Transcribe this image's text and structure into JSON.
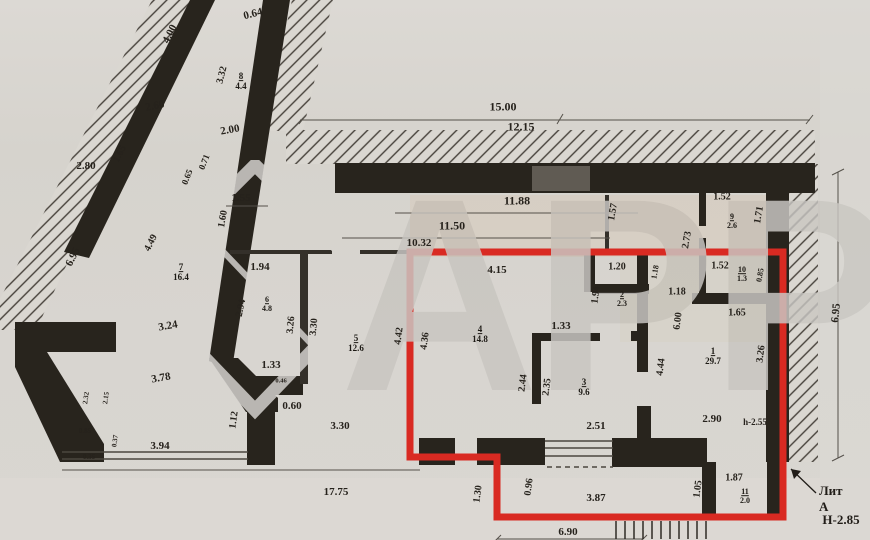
{
  "plan": {
    "watermark": "АРР",
    "litera": "Лит А",
    "height_note": "Н-2.85",
    "colors": {
      "red_outline": "#d92a22",
      "wall": "#28241d",
      "paper": "#d7d4cf"
    },
    "rooms": [
      {
        "n": "8",
        "a": "4.4",
        "x": 241,
        "y": 82,
        "s": 9
      },
      {
        "n": "7",
        "a": "16.4",
        "x": 181,
        "y": 273,
        "s": 9
      },
      {
        "n": "6",
        "a": "4.8",
        "x": 267,
        "y": 305,
        "s": 8
      },
      {
        "n": "5",
        "a": "12.6",
        "x": 356,
        "y": 344,
        "s": 9
      },
      {
        "n": "9",
        "a": "2.6",
        "x": 732,
        "y": 222,
        "s": 8
      },
      {
        "n": "10",
        "a": "1.3",
        "x": 742,
        "y": 275,
        "s": 8
      },
      {
        "n": "2",
        "a": "2.3",
        "x": 622,
        "y": 300,
        "s": 8
      },
      {
        "n": "4",
        "a": "14.8",
        "x": 480,
        "y": 335,
        "s": 9
      },
      {
        "n": "1",
        "a": "29.7",
        "x": 713,
        "y": 357,
        "s": 9
      },
      {
        "n": "3",
        "a": "9.6",
        "x": 584,
        "y": 388,
        "s": 9
      },
      {
        "n": "11",
        "a": "2.0",
        "x": 745,
        "y": 497,
        "s": 8
      }
    ],
    "dimensions": [
      {
        "t": "0.64",
        "x": 253,
        "y": 14,
        "r": -14,
        "s": 11
      },
      {
        "t": "4.00",
        "x": 170,
        "y": 34,
        "r": -63,
        "s": 11
      },
      {
        "t": "3.32",
        "x": 222,
        "y": 75,
        "r": -76,
        "s": 10
      },
      {
        "t": "2.60",
        "x": 155,
        "y": 106,
        "r": -12,
        "s": 11
      },
      {
        "t": "2.00",
        "x": 230,
        "y": 130,
        "r": -10,
        "s": 11
      },
      {
        "t": "1.65",
        "x": 120,
        "y": 154,
        "r": -63,
        "s": 10
      },
      {
        "t": "2.80",
        "x": 86,
        "y": 166,
        "r": 0,
        "s": 11
      },
      {
        "t": "0.71",
        "x": 204,
        "y": 162,
        "r": -68,
        "s": 9
      },
      {
        "t": "0.65",
        "x": 187,
        "y": 177,
        "r": -68,
        "s": 9
      },
      {
        "t": "1.55",
        "x": 241,
        "y": 198,
        "r": 0,
        "s": 11
      },
      {
        "t": "1.60",
        "x": 223,
        "y": 219,
        "r": -80,
        "s": 10
      },
      {
        "t": "6.95",
        "x": 73,
        "y": 257,
        "r": -63,
        "s": 11
      },
      {
        "t": "4.49",
        "x": 151,
        "y": 243,
        "r": -63,
        "s": 10
      },
      {
        "t": "3.24",
        "x": 168,
        "y": 326,
        "r": -10,
        "s": 11
      },
      {
        "t": "3.78",
        "x": 161,
        "y": 378,
        "r": -10,
        "s": 11
      },
      {
        "t": "2.32",
        "x": 86,
        "y": 398,
        "r": -82,
        "s": 7
      },
      {
        "t": "2.15",
        "x": 106,
        "y": 398,
        "r": -82,
        "s": 7
      },
      {
        "t": "0.85",
        "x": 85,
        "y": 431,
        "r": 0,
        "s": 7
      },
      {
        "t": "0.37",
        "x": 115,
        "y": 441,
        "r": -82,
        "s": 7
      },
      {
        "t": "0.35",
        "x": 89,
        "y": 457,
        "r": 0,
        "s": 7
      },
      {
        "t": "3.94",
        "x": 160,
        "y": 446,
        "r": 0,
        "s": 11
      },
      {
        "t": "1.12",
        "x": 234,
        "y": 420,
        "r": -82,
        "s": 10
      },
      {
        "t": "2.94",
        "x": 241,
        "y": 308,
        "r": -78,
        "s": 10
      },
      {
        "t": "1.94",
        "x": 260,
        "y": 267,
        "r": 0,
        "s": 11
      },
      {
        "t": "3.26",
        "x": 291,
        "y": 325,
        "r": -85,
        "s": 10
      },
      {
        "t": "3.30",
        "x": 314,
        "y": 327,
        "r": -85,
        "s": 10
      },
      {
        "t": "1.33",
        "x": 271,
        "y": 365,
        "r": 0,
        "s": 11
      },
      {
        "t": "0.46",
        "x": 281,
        "y": 381,
        "r": 0,
        "s": 6.5
      },
      {
        "t": "0.60",
        "x": 292,
        "y": 406,
        "r": 0,
        "s": 11
      },
      {
        "t": "3.30",
        "x": 340,
        "y": 426,
        "r": 0,
        "s": 11
      },
      {
        "t": "17.75",
        "x": 336,
        "y": 492,
        "r": 0,
        "s": 11
      },
      {
        "t": "15.00",
        "x": 503,
        "y": 107,
        "r": 0,
        "s": 12
      },
      {
        "t": "12.15",
        "x": 521,
        "y": 127,
        "r": 0,
        "s": 12
      },
      {
        "t": "11.88",
        "x": 517,
        "y": 201,
        "r": 0,
        "s": 12
      },
      {
        "t": "11.50",
        "x": 452,
        "y": 226,
        "r": 0,
        "s": 12
      },
      {
        "t": "10.32",
        "x": 419,
        "y": 243,
        "r": 0,
        "s": 11
      },
      {
        "t": "1.57",
        "x": 613,
        "y": 212,
        "r": -80,
        "s": 10
      },
      {
        "t": "1.52",
        "x": 722,
        "y": 197,
        "r": 0,
        "s": 10
      },
      {
        "t": "1.71",
        "x": 759,
        "y": 215,
        "r": -80,
        "s": 10
      },
      {
        "t": "2.73",
        "x": 687,
        "y": 240,
        "r": -80,
        "s": 10
      },
      {
        "t": "1.52",
        "x": 720,
        "y": 266,
        "r": 0,
        "s": 10
      },
      {
        "t": "0.85",
        "x": 760,
        "y": 275,
        "r": -80,
        "s": 8
      },
      {
        "t": "1.18",
        "x": 655,
        "y": 272,
        "r": -80,
        "s": 8
      },
      {
        "t": "1.18",
        "x": 677,
        "y": 292,
        "r": 0,
        "s": 10
      },
      {
        "t": "6.00",
        "x": 678,
        "y": 321,
        "r": -83,
        "s": 10
      },
      {
        "t": "1.65",
        "x": 737,
        "y": 313,
        "r": 0,
        "s": 10
      },
      {
        "t": "3.26",
        "x": 761,
        "y": 354,
        "r": -83,
        "s": 10
      },
      {
        "t": "4.44",
        "x": 661,
        "y": 367,
        "r": -83,
        "s": 10
      },
      {
        "t": "1.20",
        "x": 617,
        "y": 267,
        "r": 0,
        "s": 10
      },
      {
        "t": "1.94",
        "x": 596,
        "y": 295,
        "r": -83,
        "s": 10
      },
      {
        "t": "4.15",
        "x": 497,
        "y": 270,
        "r": 0,
        "s": 11
      },
      {
        "t": "4.36",
        "x": 425,
        "y": 341,
        "r": -83,
        "s": 10
      },
      {
        "t": "4.42",
        "x": 399,
        "y": 336,
        "r": -83,
        "s": 10
      },
      {
        "t": "1.33",
        "x": 561,
        "y": 326,
        "r": 0,
        "s": 11
      },
      {
        "t": "2.44",
        "x": 523,
        "y": 383,
        "r": -83,
        "s": 10
      },
      {
        "t": "2.35",
        "x": 547,
        "y": 387,
        "r": -83,
        "s": 10
      },
      {
        "t": "2.51",
        "x": 596,
        "y": 426,
        "r": 0,
        "s": 11
      },
      {
        "t": "2.90",
        "x": 712,
        "y": 419,
        "r": 0,
        "s": 11
      },
      {
        "t": "h-2.55",
        "x": 755,
        "y": 422,
        "r": 0,
        "s": 9,
        "b": 1
      },
      {
        "t": "1.30",
        "x": 478,
        "y": 494,
        "r": -83,
        "s": 10
      },
      {
        "t": "0.96",
        "x": 529,
        "y": 487,
        "r": -83,
        "s": 10
      },
      {
        "t": "3.87",
        "x": 596,
        "y": 498,
        "r": 0,
        "s": 11
      },
      {
        "t": "1.05",
        "x": 698,
        "y": 489,
        "r": -83,
        "s": 10
      },
      {
        "t": "1.87",
        "x": 734,
        "y": 478,
        "r": 0,
        "s": 10
      },
      {
        "t": "6.90",
        "x": 568,
        "y": 532,
        "r": 0,
        "s": 11
      },
      {
        "t": "6.95",
        "x": 836,
        "y": 313,
        "r": -85,
        "s": 11
      }
    ]
  }
}
